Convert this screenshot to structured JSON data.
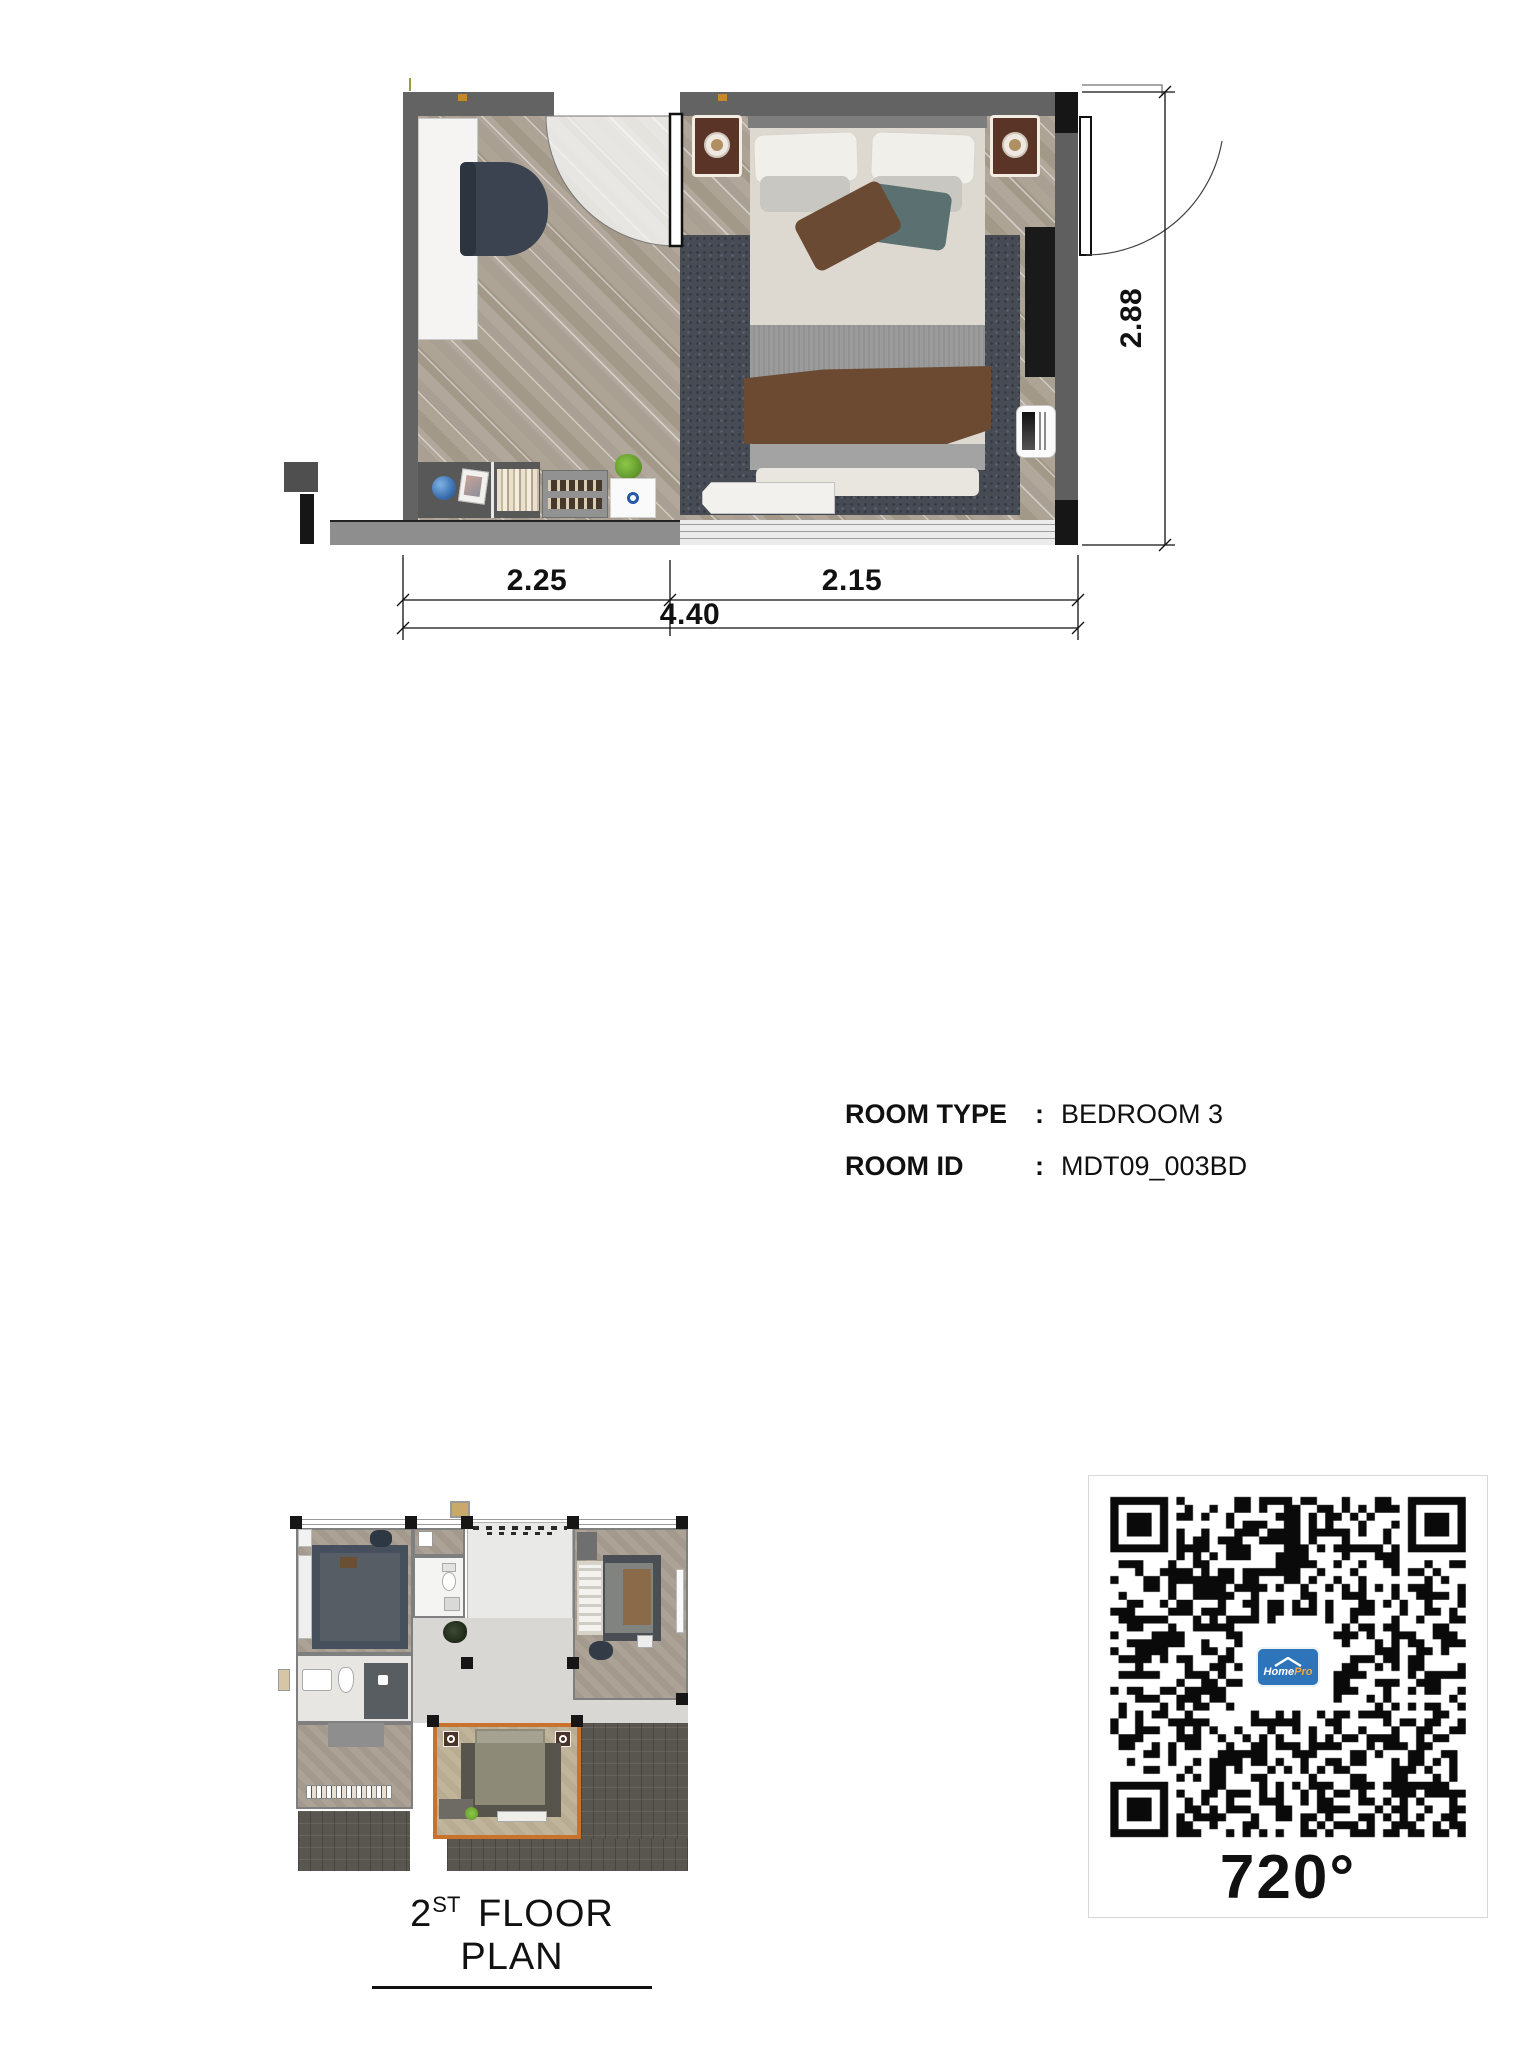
{
  "info": {
    "rows": [
      {
        "label": "ROOM TYPE",
        "sep": ":",
        "value": "BEDROOM 3"
      },
      {
        "label": "ROOM ID",
        "sep": ":",
        "value": "MDT09_003BD"
      }
    ]
  },
  "main_plan": {
    "dims": {
      "left": "2.25",
      "right": "2.15",
      "total": "4.40",
      "height": "2.88"
    }
  },
  "mini_plan": {
    "caption_num": "2",
    "caption_sup": "ST",
    "caption_rest": "FLOOR PLAN"
  },
  "qr": {
    "caption": "720°",
    "logo_home": "Home",
    "logo_pro": "Pro"
  },
  "colors": {
    "accent_highlight": "#c9722e",
    "wall": "#636363",
    "logo_blue": "#2e74ba",
    "logo_orange": "#f0a93c"
  }
}
